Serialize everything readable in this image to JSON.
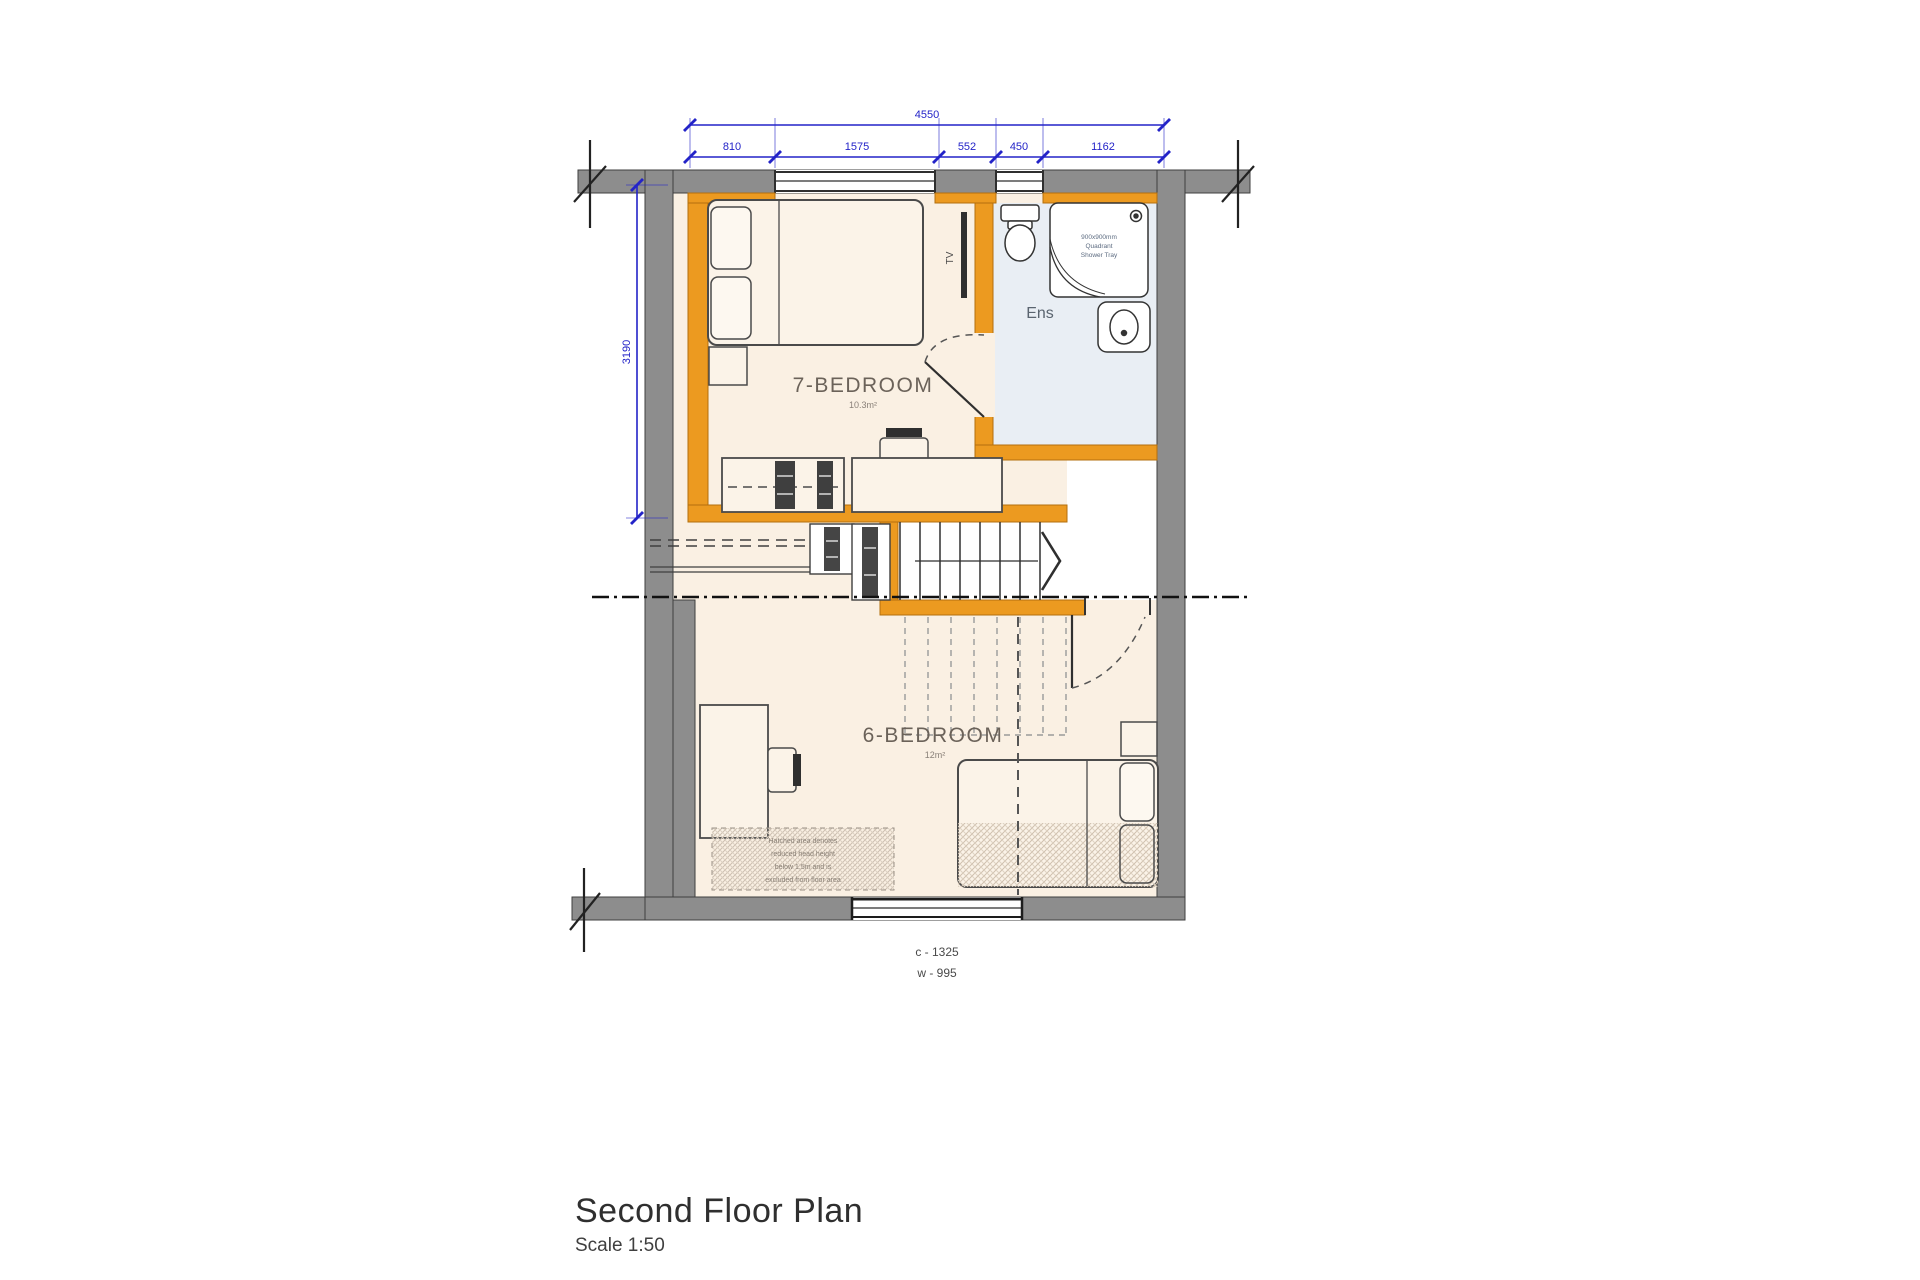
{
  "colors": {
    "dimension_blue": "#2323c8",
    "wall_grey": "#8d8d8d",
    "partition_orange": "#ec9a20",
    "floor_cream": "#faf0e3",
    "ensuite_blue": "#e9eef4"
  },
  "dimensions": {
    "overall_width": "4550",
    "segments": [
      "810",
      "1575",
      "552",
      "450",
      "1162"
    ],
    "overall_height": "3190"
  },
  "rooms": {
    "bedroom7": {
      "name": "7-BEDROOM",
      "area": "10.3m²"
    },
    "bedroom6": {
      "name": "6-BEDROOM",
      "area": "12m²"
    },
    "ensuite": {
      "name": "Ens"
    }
  },
  "labels": {
    "tv": "TV",
    "shower_tray": [
      "900x900mm",
      "Quadrant",
      "Shower Tray"
    ],
    "eaves_note": [
      "Hatched area denotes",
      "reduced head height",
      "below 1.5m and is",
      "excluded from floor area"
    ],
    "window": [
      "c - 1325",
      "w - 995"
    ]
  },
  "title_block": {
    "title": "Second Floor Plan",
    "scale": "Scale 1:50"
  }
}
